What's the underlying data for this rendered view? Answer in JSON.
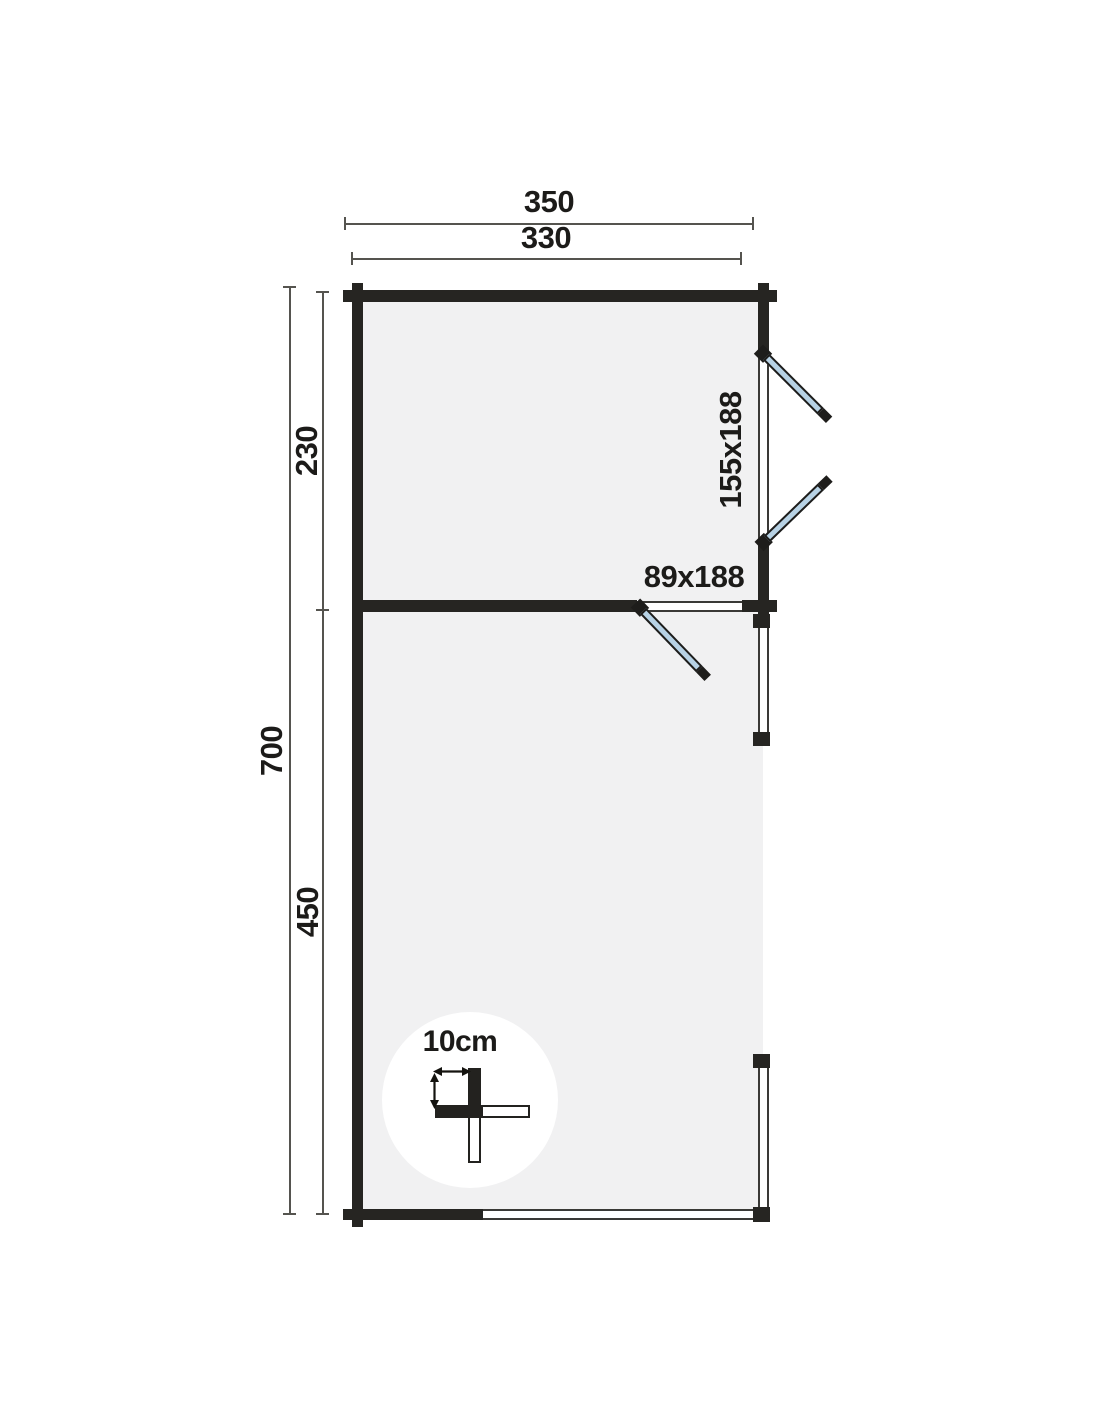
{
  "labels": {
    "overall_width": "350",
    "inner_width": "330",
    "overall_depth": "700",
    "room1_depth": "230",
    "room2_depth": "450",
    "window_size": "155x188",
    "door_size": "89x188",
    "scale": "10cm"
  },
  "colors": {
    "wall": "#262522",
    "floor": "#f1f1f2",
    "glass": "#b7d2e5",
    "line": "#55544f",
    "text": "#1c1b19",
    "background": "#ffffff"
  }
}
